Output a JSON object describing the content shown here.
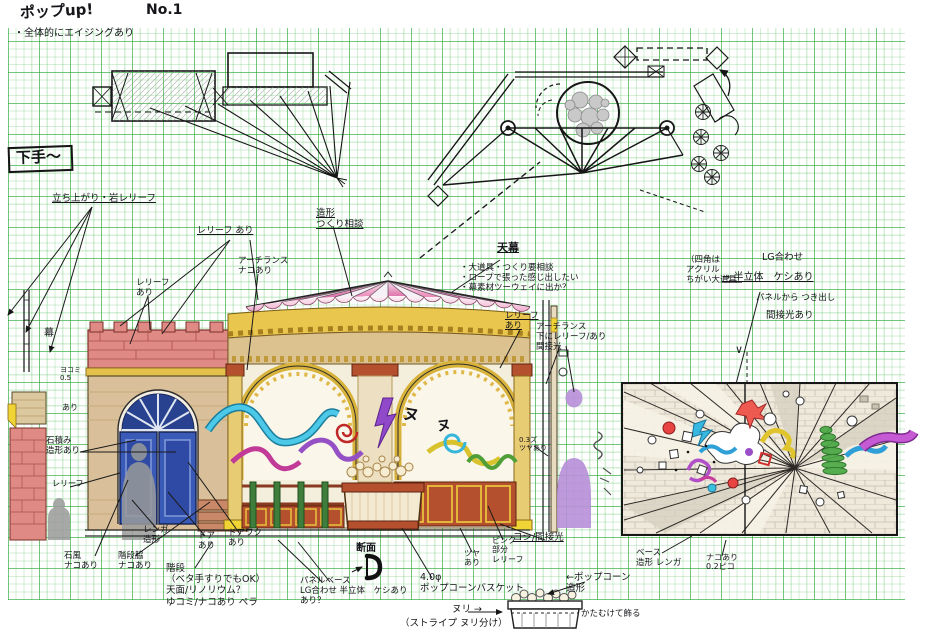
{
  "sheet": {
    "title": "ポップup!",
    "page_no": "No.1",
    "aging_note": "・全体的にエイジングあり",
    "stage_side": "下手〜"
  },
  "palette": {
    "grid_green": "#34aa42",
    "ink": "#1a1a1a",
    "brick_pink": "#e08a85",
    "wall_tan": "#d9c09a",
    "gold_band": "#e9c64e",
    "trim_yellow": "#f0d435",
    "tent_pink": "#e0559a",
    "tent_magenta": "#c4458e",
    "door_blue": "#3a5ab8",
    "fence_red": "#b5502e",
    "post_green": "#3f7d3c",
    "ribbon_cyan": "#35b6da",
    "ribbon_magenta": "#c23a98",
    "ribbon_purple": "#9450c4",
    "ribbon_yellow": "#d8c22e",
    "spiral_red": "#c02828",
    "coil_green": "#3fa03f",
    "silhouette_grey": "#9a9a9a",
    "silhouette_purple": "#b88fd9",
    "panel_beige": "#efe9dc"
  },
  "labels": {
    "standup_relief": "立ち上がり・岩レリーフ",
    "relief_ari_top": "レリーフ あり",
    "arch_lance_naco": "アーチランス\nナコあり",
    "relief_ari_left": "レリーフ\nあり",
    "zokei_tsukuri": "造形\nつくり相談",
    "tenmaku": "天幕",
    "tenmaku_notes": "・大道具・つくり要相談\n・ロープで張った感じ出したい\n・幕素材ツーウェイに出か？",
    "relief_ari_right": "レリーフ\nあり",
    "arch_lance_shita": "アーチランス\n下にレリーフ/あり\n間接光",
    "shikaku_acrylic": "（四角は\nアクリル\nちがい大道具",
    "lg_awase": "LG合わせ",
    "han_rittai": "→ 半立体　ケシあり",
    "panel_tsukidashi": "パネルから つき出し",
    "kansetsu_ari": "間接光あり",
    "v_mark": "∨",
    "maku": "幕",
    "yokomi": "ヨコミ\n0.5",
    "ari_small": "あり",
    "ishizumi": "石積み\n造形あり",
    "relief_small": "レリーフ",
    "ishifu": "石風\nナコあり",
    "kaidan_waki": "階段脇\nナコあり",
    "renga_zokei": "レンガ\n造形",
    "door_ari": "ドア\nあり",
    "doorwaku_ari": "ドアワク\nあり",
    "kaidan_notes": "階段\n（ベタ手すりでもOK）\n天面/リノリウム？\nゆコミ/ナコあり ペラ",
    "danmen": "断面",
    "panel_base": "パネルベース\nLG合わせ 半立体　ケシあり\nあり？",
    "popcorn_dia": "4.0φ\nポップコーンバスケット",
    "nuri_arrow": "ヌリ →",
    "stripe_nuri": "（ストライプ ヌリ分け）",
    "tsuya_ari": "ツヤ\nあり",
    "pink_relief": "ピンク\n部分\nレリーフ",
    "koshi_kansetsu": "コシ/間接光",
    "popcorn_zokei": "←ポップコーン\n造形",
    "katamukete": "かたむけて飾る",
    "base_renga": "ベース\n造形 レンガ",
    "naco_02": "ナコあり\n0.2ピコ",
    "zero3": "0.3ズ\nツヤあり",
    "deco_nu1": "ヌ",
    "deco_nu2": "ヌ"
  }
}
